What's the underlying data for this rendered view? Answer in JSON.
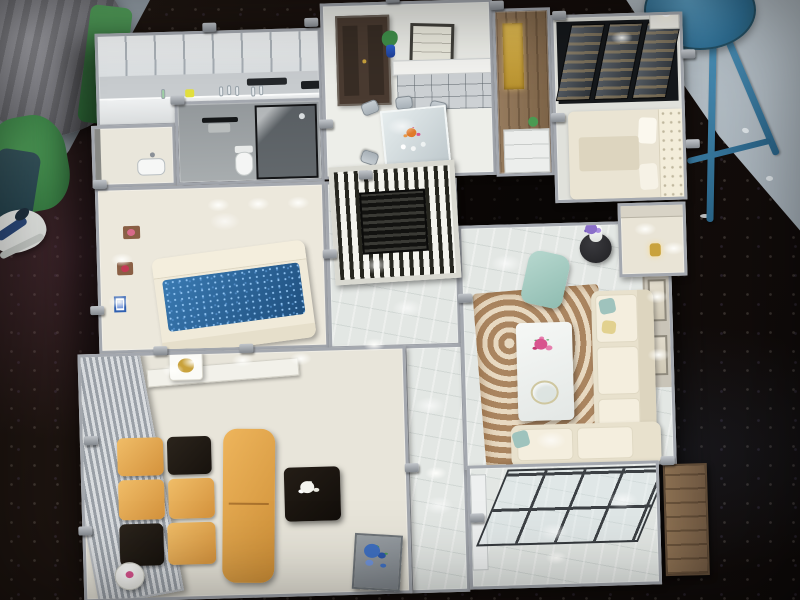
{
  "scene": {
    "type": "photograph",
    "subject": "Miniature apartment scale model (dollhouse-style cutaway) viewed from above",
    "setting": "Model displayed on a dark glittery exhibition table in a showroom",
    "camera": "High-angle overhead view with slight tilt",
    "visible_text": "none"
  },
  "palette": {
    "table_dark": "#17110e",
    "showroom_floor": "#b3bdc5",
    "model_wall": "#a4a8af",
    "floor_cream": "#ece8dc",
    "floor_marble": "#e4e8e5",
    "bathroom_gray": "#9aa0a2",
    "door_brown": "#4a3b31",
    "screen_black": "#26261f",
    "bed_blue": "#2a6296",
    "sofa_gold": "#e0a24c",
    "cushion_black": "#201a14",
    "rug_brown": "#aa8560",
    "rug_cream": "#e8d9c1",
    "armchair_mint": "#a7cdc3",
    "flower_pink": "#d8548e",
    "flower_purple": "#8b6fc9",
    "flower_blue": "#3f6fc0",
    "stool_blue": "#3f85ad",
    "wood_brown": "#7d6347",
    "accent_gold": "#c9a23c"
  },
  "background": {
    "table": {
      "label": "Dark glitter exhibition table"
    },
    "showroom_floor": {
      "label": "Pale blue-gray showroom floor"
    },
    "stool": {
      "label": "Blue metal stool"
    },
    "bystander": {
      "label": "Bystander's leg with white sneaker"
    },
    "covered_object": {
      "label": "Gray cloth-covered object"
    },
    "green_stand": {
      "label": "Green display stand"
    }
  },
  "model": {
    "label": "Apartment interior scale model",
    "lighting": "Miniature LED ceiling and wall lights",
    "rooms": [
      {
        "key": "kitchen",
        "label": "Kitchen",
        "items": [
          "Upper cabinets",
          "Counter with miniature bottles",
          "Cooktop"
        ]
      },
      {
        "key": "utility",
        "label": "Utility room",
        "items": [
          "Wash basin",
          "Glass door"
        ]
      },
      {
        "key": "bathroom",
        "label": "Bathroom",
        "items": [
          "Toilet",
          "Black towel rack",
          "Glass shower enclosure"
        ]
      },
      {
        "key": "dining",
        "label": "Dining room",
        "items": [
          "Dark entry door",
          "Sideboard with shelves",
          "Leaning wall art",
          "Plant in blue vase",
          "Glass dining table",
          "Six chairs",
          "Orange flower centerpiece"
        ]
      },
      {
        "key": "pantry_wall",
        "label": "Wood cabinet wall",
        "items": [
          "Gold display niche",
          "White base cabinet",
          "Small plant"
        ]
      },
      {
        "key": "master_bedroom",
        "label": "Master bedroom",
        "items": [
          "Wardrobe with dark glass sliding doors",
          "Bed with tufted headboard",
          "Dresser with white table lamp"
        ]
      },
      {
        "key": "dressing_niche",
        "label": "Lit dressing niche",
        "items": [
          "Gold ornament",
          "Accent lighting"
        ]
      },
      {
        "key": "second_bedroom",
        "label": "Second bedroom",
        "items": [
          "Bed with sparkly blue cover",
          "Wall shelves with red decor",
          "Small blue picture frame",
          "Wall spotlights"
        ]
      },
      {
        "key": "hallway",
        "label": "Hallway",
        "items": [
          "Black slatted partition screen",
          "Marble floor"
        ]
      },
      {
        "key": "living_room",
        "label": "Living room",
        "items": [
          "White L-shaped sofa",
          "Teal and yellow pillows",
          "Mint armchair",
          "White marble coffee table",
          "Pink flower arrangement",
          "Round black side table",
          "White vase with purple flowers",
          "Swirl-pattern area rug",
          "Framed wall art"
        ]
      },
      {
        "key": "lounge",
        "label": "TV lounge",
        "items": [
          "Striped metal feature wall",
          "Gold sofa with black cushions",
          "Gold chaise bench",
          "Black coffee table",
          "White flower arrangement",
          "White side tables with gold ornaments"
        ]
      },
      {
        "key": "corridor",
        "label": "Corridor",
        "items": [
          "Marble floor",
          "Blue flower planter"
        ]
      },
      {
        "key": "balcony",
        "label": "Balcony",
        "items": [
          "Dark-framed glass doors",
          "Wood sideboard",
          "Marble floor"
        ]
      }
    ]
  }
}
